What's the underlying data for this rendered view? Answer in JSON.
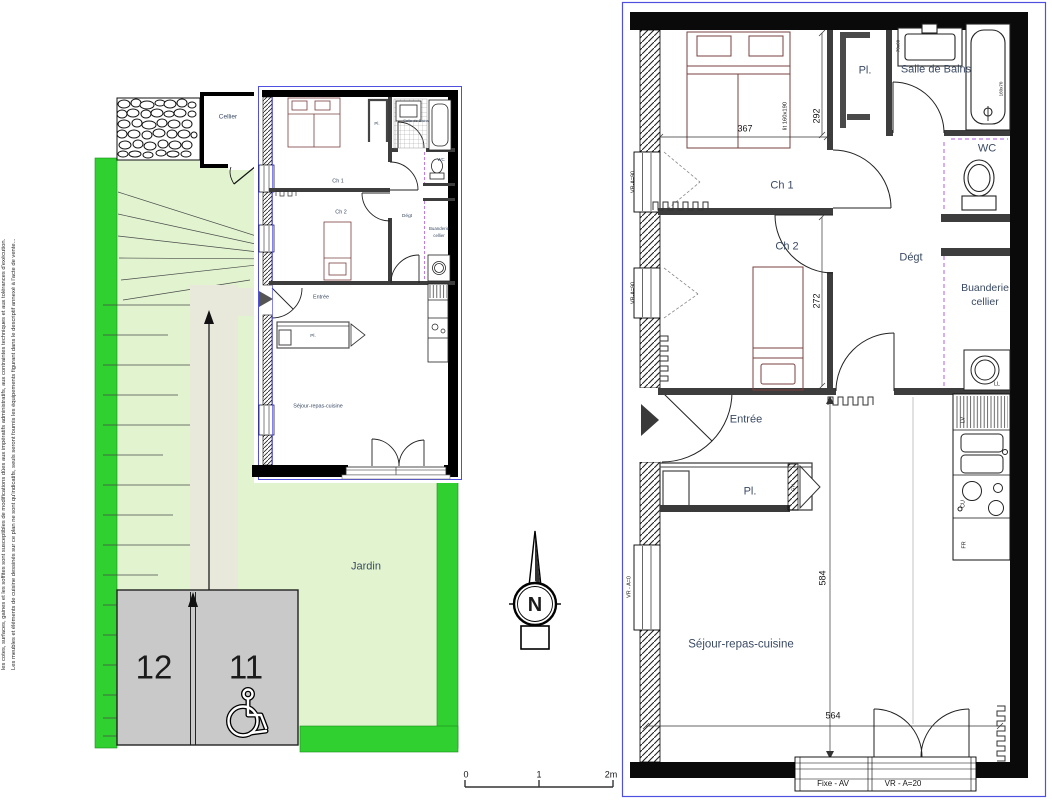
{
  "colors": {
    "garden_light": "#e1f4cf",
    "garden_bright": "#2fd02f",
    "path_beige": "#e9e9db",
    "parking_gray": "#c9c9c9",
    "frame_blue": "#4f4fe0",
    "furniture_maroon": "#7a4040",
    "dashed_violet": "#c17ae8",
    "wall_black": "#0a0a0a",
    "label_blue_gray": "#3a4a63"
  },
  "disclaimer": {
    "line1": "les cotes, surfaces, gaines et les soffites sont susceptibles de modifications dûes aux impératifs administratifs, aux contraintes techniques et aux tolérances d'exécution.",
    "line2": "Les meubles et éléments de cuisine dessinés sur ce plan ne sont qu'indicatifs, seuls seront fournis les équipements figurant dans le descriptif annexé à l'acte de vente..."
  },
  "site_plan": {
    "jardin": "Jardin",
    "cellier": "Cellier",
    "parking": {
      "left": "12",
      "right": "11"
    },
    "mini": {
      "ch1": "Ch 1",
      "ch2": "Ch 2",
      "pl_top": "Pl.",
      "sdb": "Salle de Bains",
      "wc": "WC",
      "degt": "Dégt",
      "buanderie_line1": "Buanderie",
      "buanderie_line2": "cellier",
      "entree": "Entrée",
      "pl": "Pl.",
      "sejour": "Séjour-repas-cuisine"
    }
  },
  "compass": {
    "north": "N"
  },
  "scale_bar": {
    "zero": "0",
    "one": "1",
    "two": "2m"
  },
  "plan": {
    "rooms": {
      "pl_top": "Pl.",
      "sdb": "Salle de Bains",
      "wc": "WC",
      "ch1": "Ch 1",
      "ch2": "Ch 2",
      "degt": "Dégt",
      "buanderie_line1": "Buanderie",
      "buanderie_line2": "cellier",
      "entree": "Entrée",
      "pl": "Pl.",
      "sejour": "Séjour-repas-cuisine"
    },
    "dims": {
      "ch_width": "367",
      "ch1_height": "292",
      "ch2_height": "272",
      "sejour_height": "584",
      "sejour_width": "564",
      "bed": "lit 160x190",
      "sink": "70x60",
      "bath": "160x70"
    },
    "openings": {
      "window1": "VR-A=90",
      "window2": "VR-A=90",
      "window3": "VR - A=0",
      "fixed_panel": "Fixe - AV",
      "roller": "VR - A=20",
      "gtl": "GTL"
    },
    "appliances": {
      "dishwasher": "LV",
      "cooktop": "CU",
      "fridge": "FR",
      "washer": "LL"
    }
  }
}
